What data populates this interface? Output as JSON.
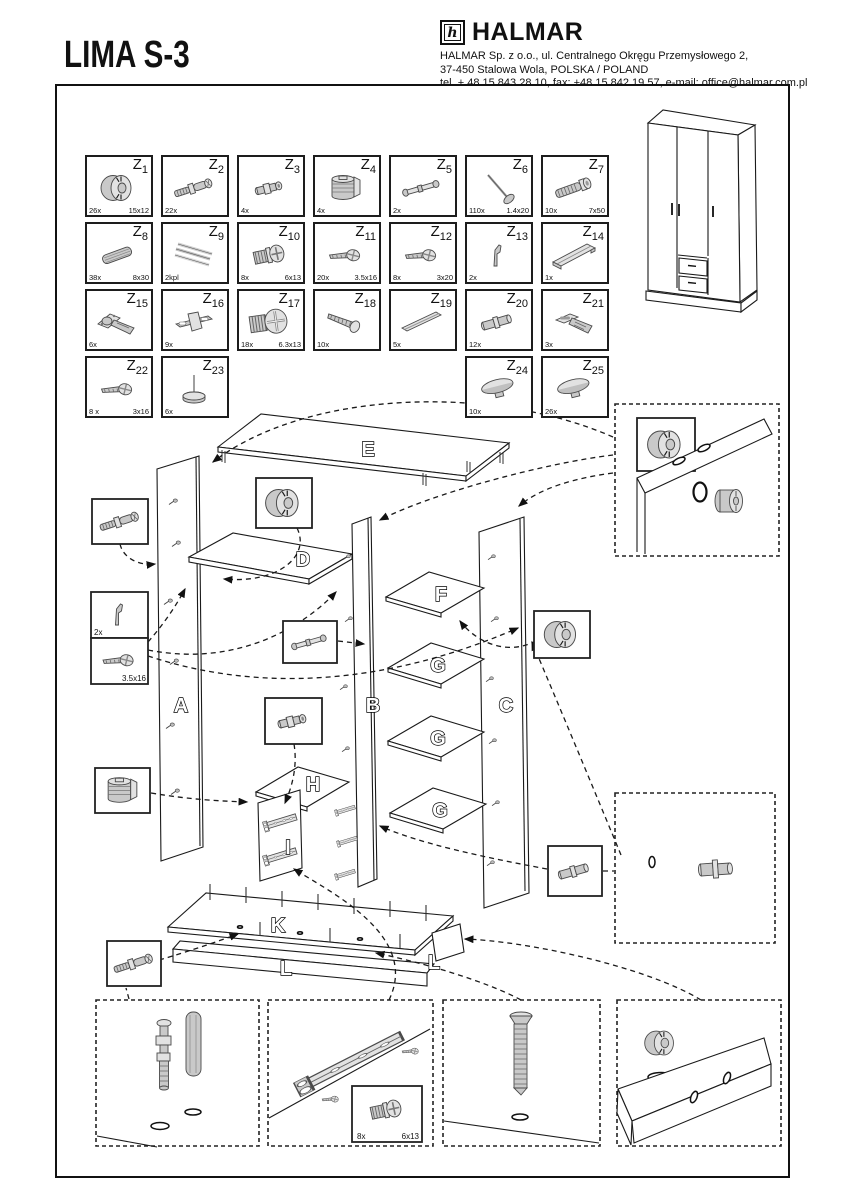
{
  "title": "LIMA S-3",
  "company": {
    "logo_mark": "h",
    "logo_text": "HALMAR",
    "address_line1": "HALMAR Sp. z o.o., ul. Centralnego Okręgu Przemysłowego 2,",
    "address_line2": "37-450 Stalowa Wola, POLSKA / POLAND",
    "address_line3": "tel. + 48 15 843 28 10, fax: +48 15 842 19 57, e-mail: office@halmar.com.pl"
  },
  "parts": [
    {
      "id": "Z1",
      "num": "1",
      "qty": "26x",
      "size": "15x12",
      "icon": "cam-lock-icon",
      "row": 0,
      "col": 0
    },
    {
      "id": "Z2",
      "num": "2",
      "qty": "22x",
      "size": "",
      "icon": "dowel-screw-icon",
      "row": 0,
      "col": 1
    },
    {
      "id": "Z3",
      "num": "3",
      "qty": "4x",
      "size": "",
      "icon": "sleeve-icon",
      "row": 0,
      "col": 2
    },
    {
      "id": "Z4",
      "num": "4",
      "qty": "4x",
      "size": "",
      "icon": "cam-housing-icon",
      "row": 0,
      "col": 3
    },
    {
      "id": "Z5",
      "num": "5",
      "qty": "2x",
      "size": "",
      "icon": "rod-icon",
      "row": 0,
      "col": 4
    },
    {
      "id": "Z6",
      "num": "6",
      "qty": "110x",
      "size": "1.4x20",
      "icon": "nail-icon",
      "row": 0,
      "col": 5
    },
    {
      "id": "Z7",
      "num": "7",
      "qty": "10x",
      "size": "7x50",
      "icon": "lag-screw-icon",
      "row": 0,
      "col": 6
    },
    {
      "id": "Z8",
      "num": "8",
      "qty": "38x",
      "size": "8x30",
      "icon": "wood-dowel-icon",
      "row": 1,
      "col": 0
    },
    {
      "id": "Z9",
      "num": "9",
      "qty": "2kpl",
      "size": "",
      "icon": "strips-icon",
      "row": 1,
      "col": 1
    },
    {
      "id": "Z10",
      "num": "10",
      "qty": "8x",
      "size": "6x13",
      "icon": "euro-screw-icon",
      "row": 1,
      "col": 2
    },
    {
      "id": "Z11",
      "num": "11",
      "qty": "20x",
      "size": "3.5x16",
      "icon": "screw-icon",
      "row": 1,
      "col": 3
    },
    {
      "id": "Z12",
      "num": "12",
      "qty": "8x",
      "size": "3x20",
      "icon": "screw-icon",
      "row": 1,
      "col": 4
    },
    {
      "id": "Z13",
      "num": "13",
      "qty": "2x",
      "size": "",
      "icon": "bracket-icon",
      "row": 1,
      "col": 5
    },
    {
      "id": "Z14",
      "num": "14",
      "qty": "1x",
      "size": "",
      "icon": "profile-icon",
      "row": 1,
      "col": 6
    },
    {
      "id": "Z15",
      "num": "15",
      "qty": "6x",
      "size": "",
      "icon": "hinge-icon",
      "row": 2,
      "col": 0
    },
    {
      "id": "Z16",
      "num": "16",
      "qty": "9x",
      "size": "",
      "icon": "plate-icon",
      "row": 2,
      "col": 1
    },
    {
      "id": "Z17",
      "num": "17",
      "qty": "18x",
      "size": "6.3x13",
      "icon": "euro-big-icon",
      "row": 2,
      "col": 2
    },
    {
      "id": "Z18",
      "num": "18",
      "qty": "10x",
      "size": "",
      "icon": "long-screw-icon",
      "row": 2,
      "col": 3
    },
    {
      "id": "Z19",
      "num": "19",
      "qty": "5x",
      "size": "",
      "icon": "rail-icon",
      "row": 2,
      "col": 4
    },
    {
      "id": "Z20",
      "num": "20",
      "qty": "12x",
      "size": "",
      "icon": "pin-icon",
      "row": 2,
      "col": 5
    },
    {
      "id": "Z21",
      "num": "21",
      "qty": "3x",
      "size": "",
      "icon": "hinge2-icon",
      "row": 2,
      "col": 6
    },
    {
      "id": "Z22",
      "num": "22",
      "qty": "8 x",
      "size": "3x16",
      "icon": "screw-icon",
      "row": 3,
      "col": 0
    },
    {
      "id": "Z23",
      "num": "23",
      "qty": "6x",
      "size": "",
      "icon": "glide-icon",
      "row": 3,
      "col": 1
    },
    {
      "id": "Z24",
      "num": "24",
      "qty": "10x",
      "size": "",
      "icon": "cap-icon",
      "row": 3,
      "col": 5
    },
    {
      "id": "Z25",
      "num": "25",
      "qty": "26x",
      "size": "",
      "icon": "cap-icon",
      "row": 3,
      "col": 6
    }
  ],
  "diagram": {
    "panel_labels": [
      "E",
      "D",
      "A",
      "B",
      "C",
      "F",
      "G",
      "G",
      "G",
      "H",
      "I",
      "K",
      "L",
      "L"
    ],
    "callout_labels": {
      "bracket_qty": "2x",
      "screw_size": "3.5x16",
      "inset_qty": "8x",
      "inset_size": "6x13"
    }
  }
}
